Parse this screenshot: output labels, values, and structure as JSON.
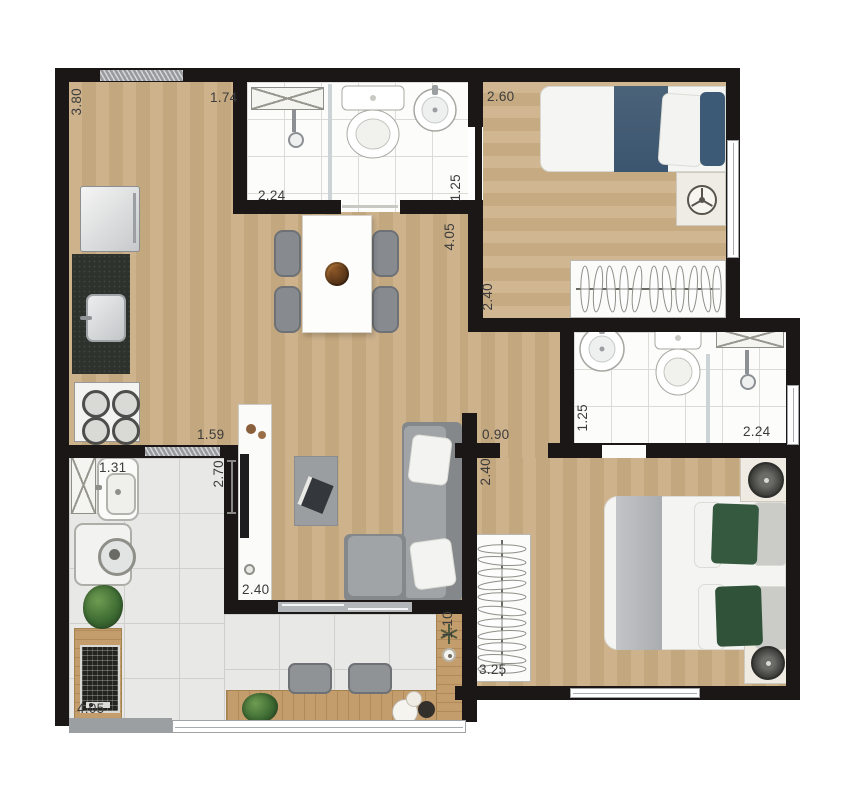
{
  "plan": {
    "colors": {
      "wall": "#1b1716",
      "wood_floor": "#c7ac85",
      "bath_tile": "#fcfcfb",
      "balcony_tile": "#e8e8e6",
      "counter_wood": "#c49d6d",
      "sofa_gray": "#8e9295",
      "blanket_navy": "#45607a",
      "pillow_green": "#35593f",
      "dimension_text": "#3c3c3c"
    },
    "dimensions": {
      "kitchen_depth": "3.80",
      "kitchen_width": "1.74",
      "bath1_width": "2.24",
      "bath1_depth": "1.25",
      "living_length": "4.05",
      "bedroom1_width": "2.60",
      "bedroom1_depth": "2.40",
      "bath2_depth": "1.25",
      "bath2_width": "2.24",
      "kitchen_opening": "1.59",
      "hall_width": "0.90",
      "bedroom2_depth": "2.40",
      "service_width": "1.31",
      "service_depth": "2.70",
      "living_width": "2.40",
      "balcony_length": "4.05",
      "balcony_counter_width": "1.10",
      "bedroom2_width": "3.25"
    }
  }
}
